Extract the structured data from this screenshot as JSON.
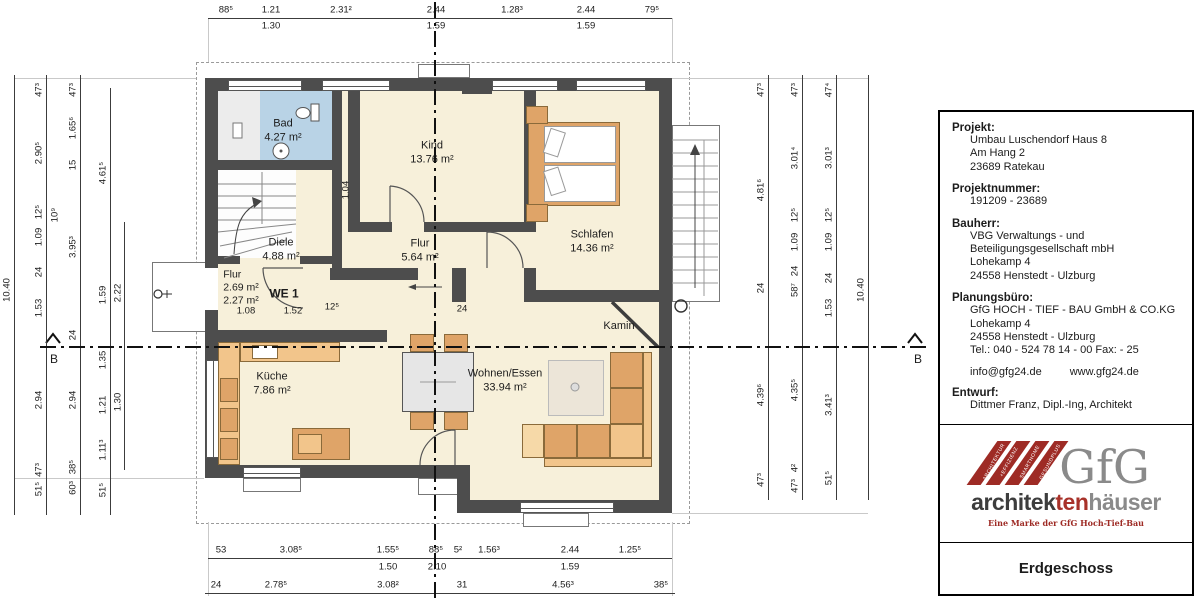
{
  "plan": {
    "rooms": {
      "bad": {
        "name": "Bad",
        "area": "4.27 m²"
      },
      "kind": {
        "name": "Kind",
        "area": "13.76 m²"
      },
      "schlafen": {
        "name": "Schlafen",
        "area": "14.36 m²"
      },
      "diele": {
        "name": "Diele",
        "area": "4.88 m²"
      },
      "flur": {
        "name": "Flur",
        "area": "5.64 m²"
      },
      "flur_we1": {
        "name": "Flur",
        "area1": "2.69 m²",
        "area2": "2.27 m²"
      },
      "we1": {
        "name": "WE 1"
      },
      "kueche": {
        "name": "Küche",
        "area": "7.86 m²"
      },
      "wohnen": {
        "name": "Wohnen/Essen",
        "area": "33.94 m²"
      },
      "kamin": {
        "name": "Kamin"
      }
    },
    "inner_dims": {
      "d104": "1.04",
      "d24": "24",
      "d108": "1.08",
      "d152": "1.52",
      "d125": "12⁵"
    },
    "section_label_left": "B",
    "section_label_right": "B"
  },
  "dims": {
    "top1": [
      "88⁵",
      "1.21",
      "2.31²",
      "2.44",
      "1.28³",
      "2.44",
      "79⁵"
    ],
    "top2": [
      "1.30",
      "1.59",
      "1.59"
    ],
    "bot1": [
      "53",
      "3.08⁵",
      "1.55⁵",
      "88⁵",
      "5²",
      "1.56³",
      "2.44",
      "1.25⁵"
    ],
    "bot2": [
      "1.50",
      "2.10",
      "1.59"
    ],
    "bot3": [
      "24",
      "2.78⁵",
      "3.08²",
      "31",
      "4.56³",
      "38⁵"
    ],
    "lA": [
      "10.40"
    ],
    "lB": [
      "47³",
      "2.90⁵",
      "12⁵",
      "1.09",
      "24",
      "1.53",
      "2.94",
      "47³",
      "51⁵"
    ],
    "lC": [
      "47³",
      "1.65⁶",
      "15",
      "10⁹",
      "3.95³",
      "24",
      "2.94",
      "38⁵",
      "60³"
    ],
    "lD": [
      "4.61⁵",
      "1.59",
      "1.35",
      "1.21",
      "1.11³",
      "51⁵"
    ],
    "lE": [
      "2.22",
      "1.30"
    ],
    "r1": [
      "47³",
      "4.81⁶",
      "24",
      "4.39⁶",
      "47³"
    ],
    "r2": [
      "47³",
      "3.01⁴",
      "12⁵",
      "1.09",
      "24",
      "58⁷",
      "4.35⁵",
      "4²",
      "47³"
    ],
    "r3": [
      "47⁴",
      "3.01³",
      "12⁵",
      "1.09",
      "24",
      "1.53",
      "3.41³",
      "51⁵"
    ],
    "r4": [
      "10.40"
    ]
  },
  "title_block": {
    "projekt_label": "Projekt:",
    "projekt": [
      "Umbau Luschendorf Haus 8",
      "Am Hang 2",
      "23689 Ratekau"
    ],
    "projektnummer_label": "Projektnummer:",
    "projektnummer": "191209 - 23689",
    "bauherr_label": "Bauherr:",
    "bauherr": [
      "VBG Verwaltungs - und",
      "Beteiligungsgesellschaft mbH",
      "Lohekamp 4",
      "24558 Henstedt - Ulzburg"
    ],
    "planungsbuero_label": "Planungsbüro:",
    "planungsbuero": [
      "GfG HOCH - TIEF - BAU GmbH & CO.KG",
      "Lohekamp 4",
      "24558 Henstedt - Ulzburg",
      "Tel.: 040 - 524 78 14 - 00   Fax: - 25"
    ],
    "email": "info@gfg24.de",
    "web": "www.gfg24.de",
    "entwurf_label": "Entwurf:",
    "entwurf": "Dittmer Franz, Dipl.-Ing, Architekt",
    "floor_label": "Erdgeschoss"
  },
  "logo": {
    "gfg": "GfG",
    "wordmark_part1": "architek",
    "wordmark_part2": "ten",
    "wordmark_part3": "häuser",
    "tagline": "Eine Marke der GfG Hoch-Tief-Bau",
    "stripes": [
      "ARCHITEKTUR",
      "+EFFIZIENZ",
      "SMARTHOME",
      "GESUNDPLUS"
    ]
  },
  "colors": {
    "wall": "#4d4d4d",
    "room": "#f7f0da",
    "bath": "#b9d3e6",
    "brand_red": "#9e2b25",
    "brand_gray": "#8a8a8a"
  }
}
